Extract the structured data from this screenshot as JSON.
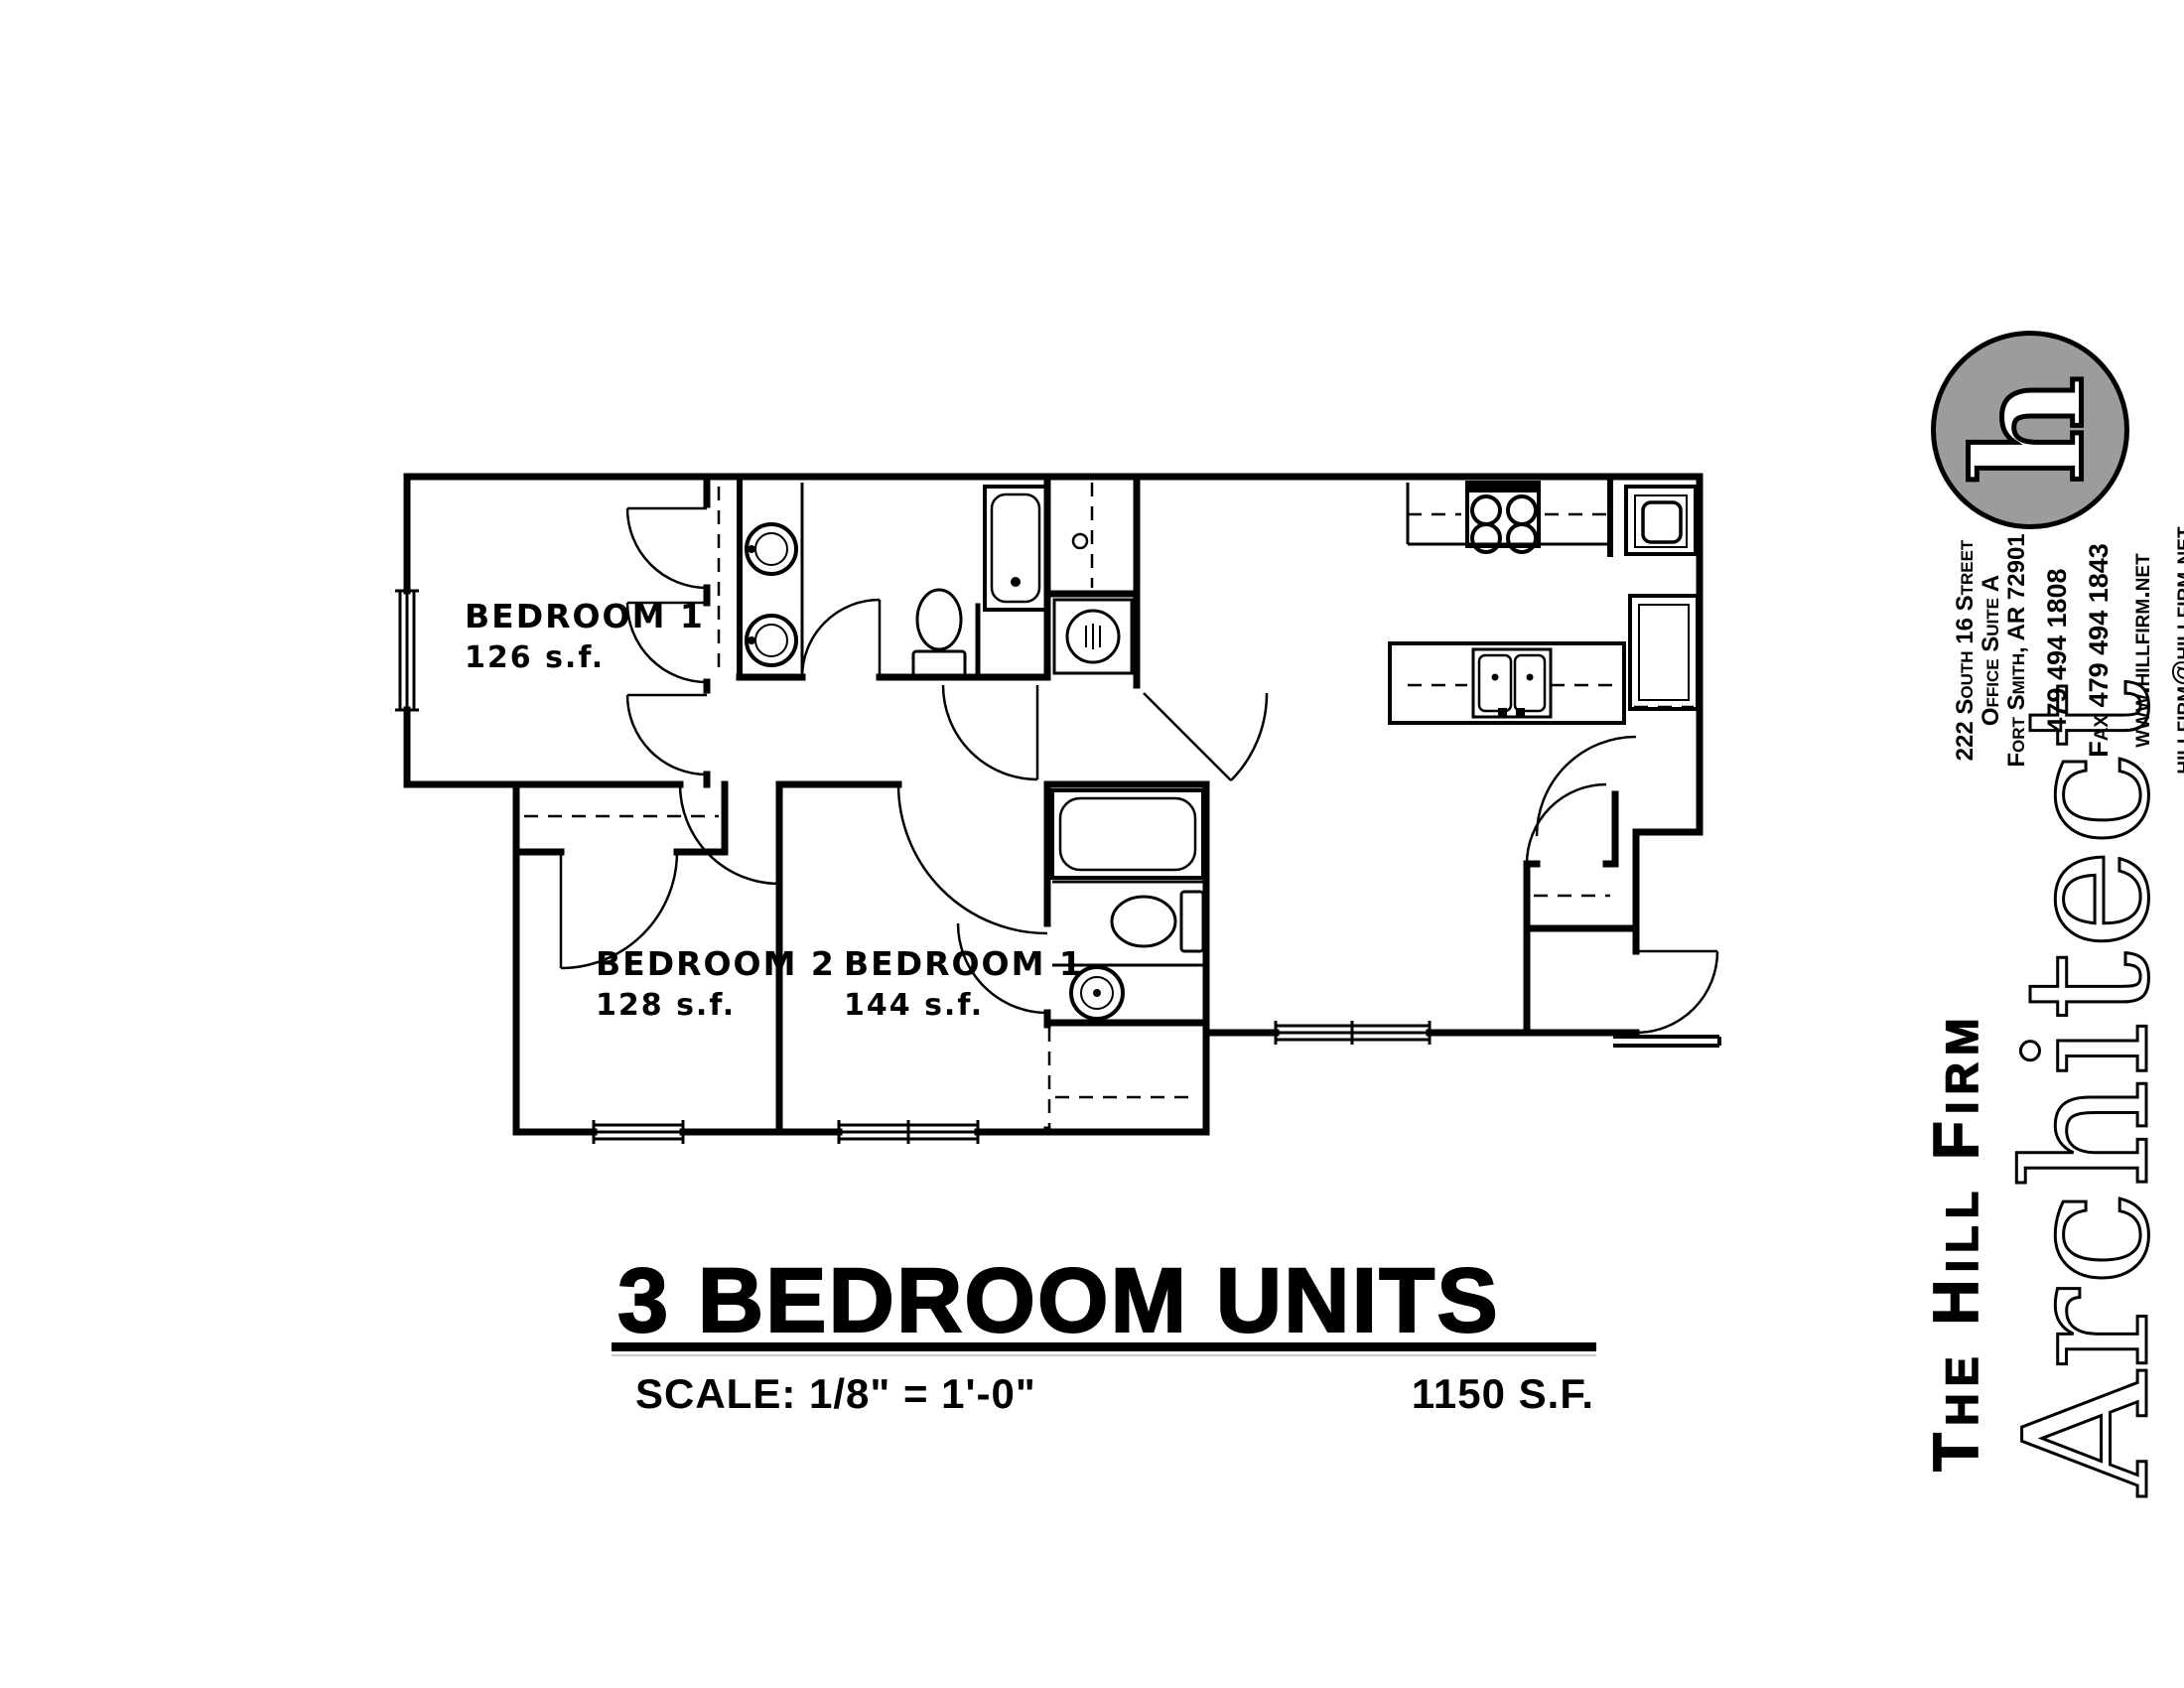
{
  "plan": {
    "rooms": [
      {
        "label": "BEDROOM 1",
        "area": "126 s.f."
      },
      {
        "label": "BEDROOM 2",
        "area": "128 s.f."
      },
      {
        "label": "BEDROOM 1",
        "area": "144 s.f."
      }
    ]
  },
  "title_block": {
    "drawing_title": "3 BEDROOM UNITS",
    "scale": "SCALE:  1/8\" = 1'-0\"",
    "area": "1150 S.F."
  },
  "firm": {
    "logo_letter": "h",
    "logo_color": "#9c9c9c",
    "name": "The Hill Firm",
    "discipline": "Architect",
    "address": [
      "222 South 16 Street",
      "Office Suite A",
      "Fort Smith, AR 72901"
    ],
    "contact": [
      "479 494 1808",
      "Fax 479 494 1843",
      "www.hillfirm.net",
      "hillfirm@hillfirm.net"
    ]
  }
}
